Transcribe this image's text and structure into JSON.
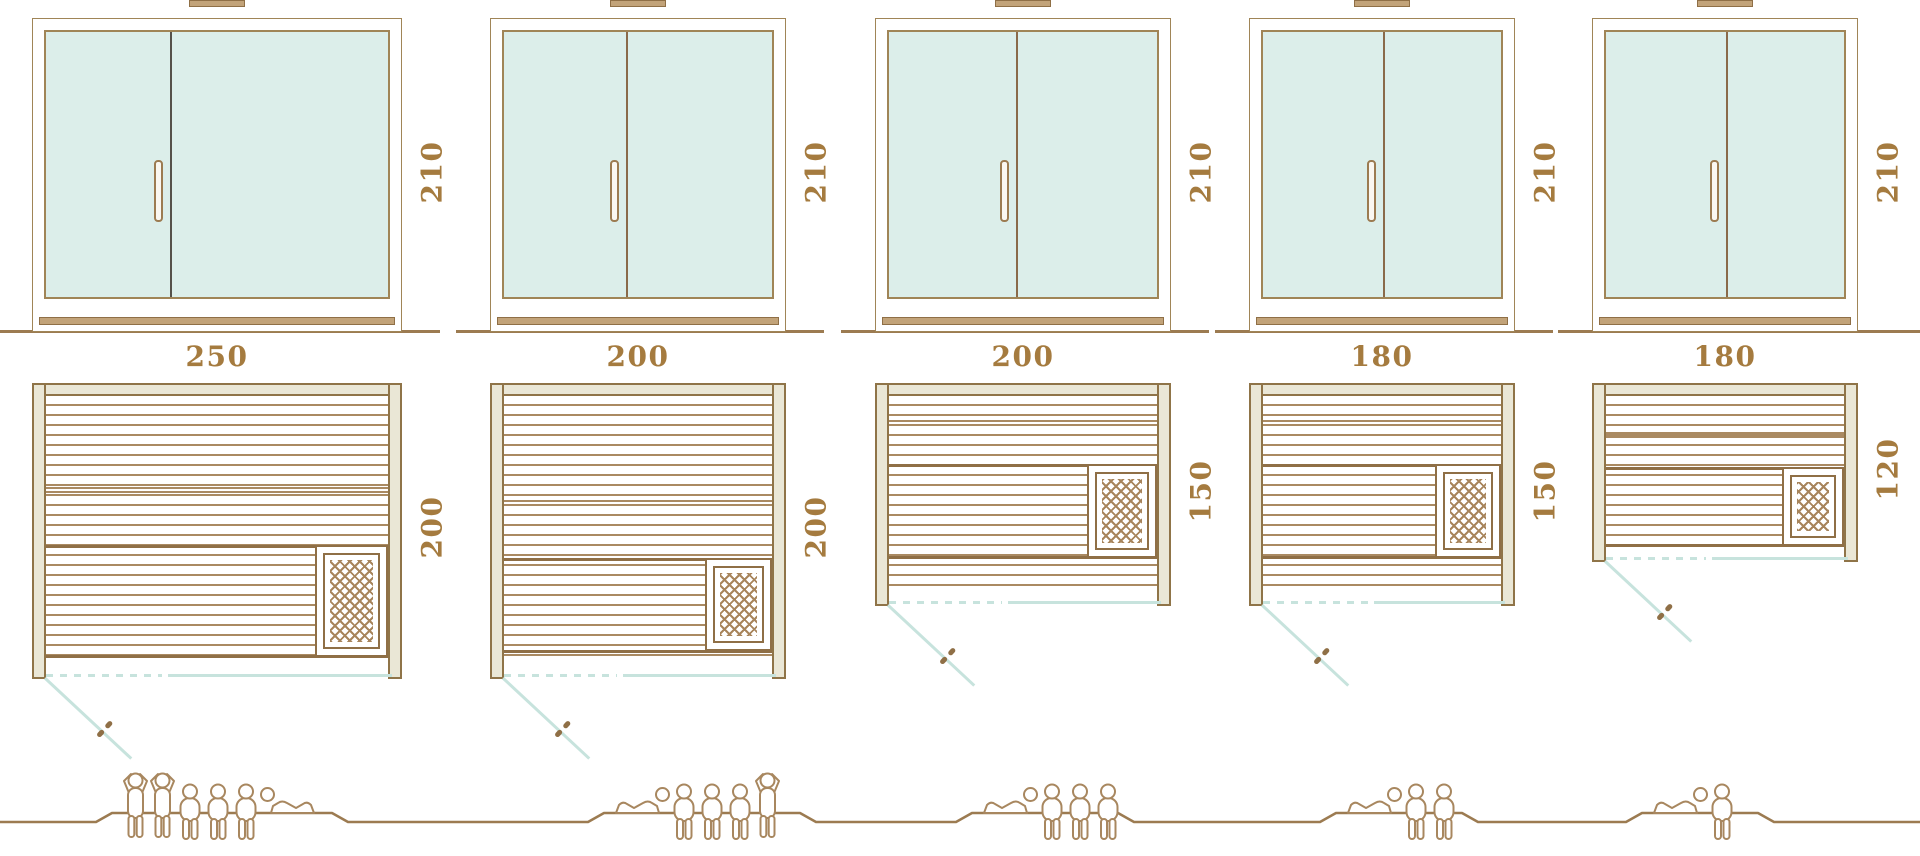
{
  "diagram": {
    "subject": "sauna-cabin-size-comparison",
    "views": [
      "front-elevation",
      "floor-plan",
      "capacity-figures"
    ]
  },
  "units": [
    {
      "id": "sauna-250x200",
      "width_label": "250",
      "depth_label": "200",
      "height_label": "210",
      "capacity": 6,
      "people": [
        "standing",
        "standing",
        "seated",
        "seated",
        "seated",
        "lying-head-left"
      ]
    },
    {
      "id": "sauna-200x200",
      "width_label": "200",
      "depth_label": "200",
      "height_label": "210",
      "capacity": 5,
      "people": [
        "lying-head-right",
        "seated",
        "seated",
        "seated",
        "standing"
      ]
    },
    {
      "id": "sauna-200x150",
      "width_label": "200",
      "depth_label": "150",
      "height_label": "210",
      "capacity": 4,
      "people": [
        "lying-head-right",
        "seated",
        "seated",
        "seated"
      ]
    },
    {
      "id": "sauna-180x150",
      "width_label": "180",
      "depth_label": "150",
      "height_label": "210",
      "capacity": 3,
      "people": [
        "lying-head-right",
        "seated",
        "seated"
      ]
    },
    {
      "id": "sauna-180x120",
      "width_label": "180",
      "depth_label": "120",
      "height_label": "210",
      "capacity": 2,
      "people": [
        "lying-head-right",
        "seated"
      ]
    }
  ],
  "icons": {
    "door-handle-icon": "vertical capsule on glass door",
    "door-swing-icon": "diagonal teal line with small handle glyph",
    "heater-icon": "square with diagonal mesh hatch",
    "roof-vent-icon": "small filled bar above door frame",
    "person-standing-icon": "outline figure standing, hands behind head",
    "person-seated-icon": "outline figure seated, legs hanging",
    "person-lying-icon": "outline figure reclining"
  },
  "colors": {
    "line": "#9c7b51",
    "frame": "#8f7448",
    "slat": "#aa8a62",
    "heavy": "#8f6f46",
    "beige": "#eae7d6",
    "glass": "#dceeea",
    "glassStroke": "#a08557",
    "teal": "#c7e3dd",
    "text": "#a57b3f",
    "figure": "#a8875f",
    "mesh": "#a8855c",
    "sill": "#c2a379",
    "divider_first": "#55514a",
    "divider": "#8a6a4a"
  }
}
